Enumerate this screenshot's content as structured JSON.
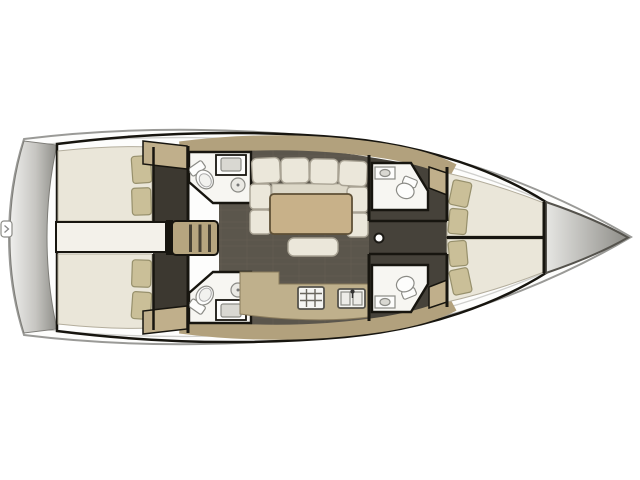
{
  "colors": {
    "background": "#ffffff",
    "hull_fill": "#fdfdfc",
    "hull_stroke": "#9a9a97",
    "rim_stroke": "#cfcfcc",
    "transom_light": "#efefed",
    "transom_dark": "#8e8d88",
    "bow_light": "#e6e6e3",
    "bow_dark": "#8d8c87",
    "interior_dark": "#2e2b25",
    "cabin_floor": "#3c3830",
    "salon_floor": "#5b564c",
    "salon_seam": "#6b6557",
    "corridor_floor": "#46423a",
    "deck_tan": "#b2a17d",
    "locker_tan": "#c0af8b",
    "stairs_tan": "#b6a57f",
    "step_dark": "#464033",
    "bed_cream": "#eae6d9",
    "seat_cream": "#ebe7da",
    "seat_shadow": "#ddd8c8",
    "pillow_tan": "#cabf98",
    "walkway_cream": "#f3f1ea",
    "head_floor": "#f7f6f2",
    "fixture_white": "#fdfdfc",
    "basin_gray": "#d9d8d2",
    "table_wood": "#c8b189",
    "counter_tan": "#bfb08c",
    "stove_white": "#f5f5f2",
    "wall_black": "#17150f",
    "mast_white": "#ffffff",
    "ladder_white": "#ffffff"
  }
}
